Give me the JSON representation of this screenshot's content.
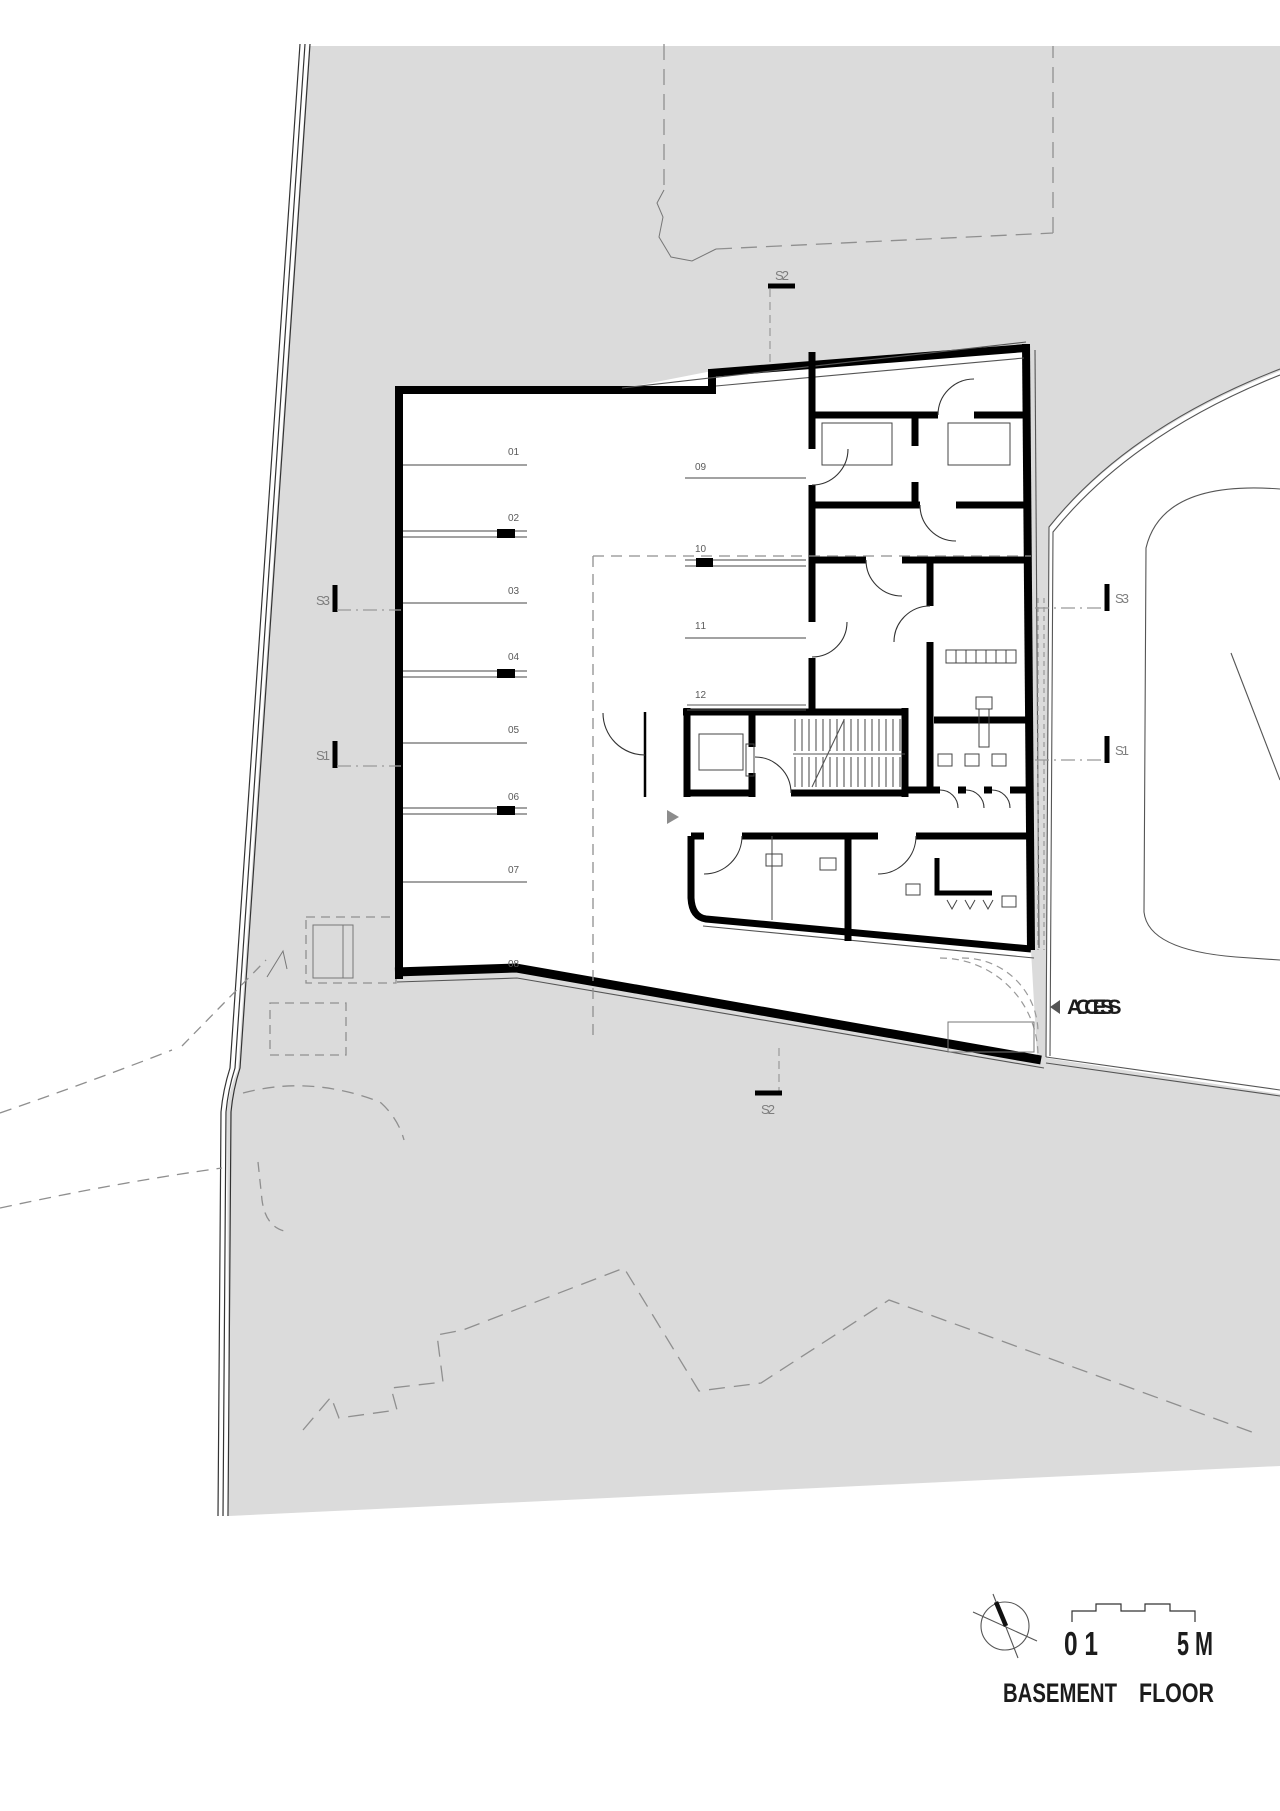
{
  "drawing": {
    "title": {
      "word1": "BASEMENT",
      "word2": "FLOOR"
    },
    "scale_bar": {
      "label_left": "0 1",
      "label_right": "5 M"
    },
    "access": {
      "label": "ACCESS"
    },
    "parking_spaces": [
      "01",
      "02",
      "03",
      "04",
      "05",
      "06",
      "07",
      "08",
      "09",
      "10",
      "11",
      "12"
    ],
    "section_markers": {
      "top": "S2",
      "bottom": "S2",
      "left_upper": "S3",
      "left_lower": "S1",
      "right_upper": "S3",
      "right_lower": "S1"
    },
    "colors": {
      "site_gray": "#dbdbdb",
      "building_fill": "#ffffff",
      "wall_black": "#000000",
      "thin_line": "#555555",
      "dashed_line": "#8f8f8f"
    }
  }
}
